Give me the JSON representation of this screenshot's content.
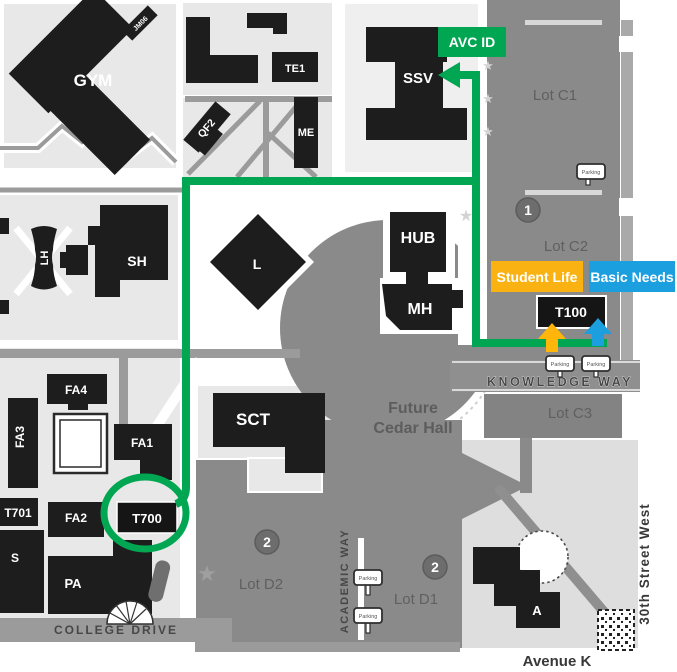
{
  "labels": {
    "buildings": {
      "gym": "GYM",
      "gym_tag": "JM06",
      "te1": "TE1",
      "me": "ME",
      "qf2": "QF2",
      "ssv": "SSV",
      "hub": "HUB",
      "mh": "MH",
      "l": "L",
      "sh": "SH",
      "lh": "LH",
      "sct": "SCT",
      "fa1": "FA1",
      "fa2": "FA2",
      "fa3": "FA3",
      "fa4": "FA4",
      "t701": "T701",
      "t700": "T700",
      "s": "S",
      "pa": "PA",
      "a": "A",
      "t100": "T100"
    },
    "lots": {
      "c1": "Lot C1",
      "c2": "Lot C2",
      "c3": "Lot C3",
      "d1": "Lot D1",
      "d2": "Lot D2"
    },
    "markers": {
      "lot_c": "1",
      "lot_d": "2"
    },
    "streets": {
      "knowledge_way": "KNOWLEDGE WAY",
      "college_drive": "COLLEGE DRIVE",
      "academic_way": "ACADEMIC WAY",
      "thirtieth_street": "30th Street  West",
      "avenue_k": "Avenue K"
    },
    "future_hall": {
      "line1": "Future",
      "line2": "Cedar Hall"
    },
    "annotations": {
      "avc_id": "AVC ID",
      "student_life": "Student Life",
      "basic_needs": "Basic Needs"
    },
    "parking": "Parking"
  },
  "colors": {
    "route_green": "#00A651",
    "student_life_orange": "#F9B212",
    "basic_needs_blue": "#1C9FDE",
    "arrow_yellow": "#FFB60A",
    "arrow_blue": "#1C9FDE",
    "building_black": "#1d1d1d",
    "parking_lot_gray": "#8a8a8a",
    "block_light_gray": "#e8e8e8"
  }
}
